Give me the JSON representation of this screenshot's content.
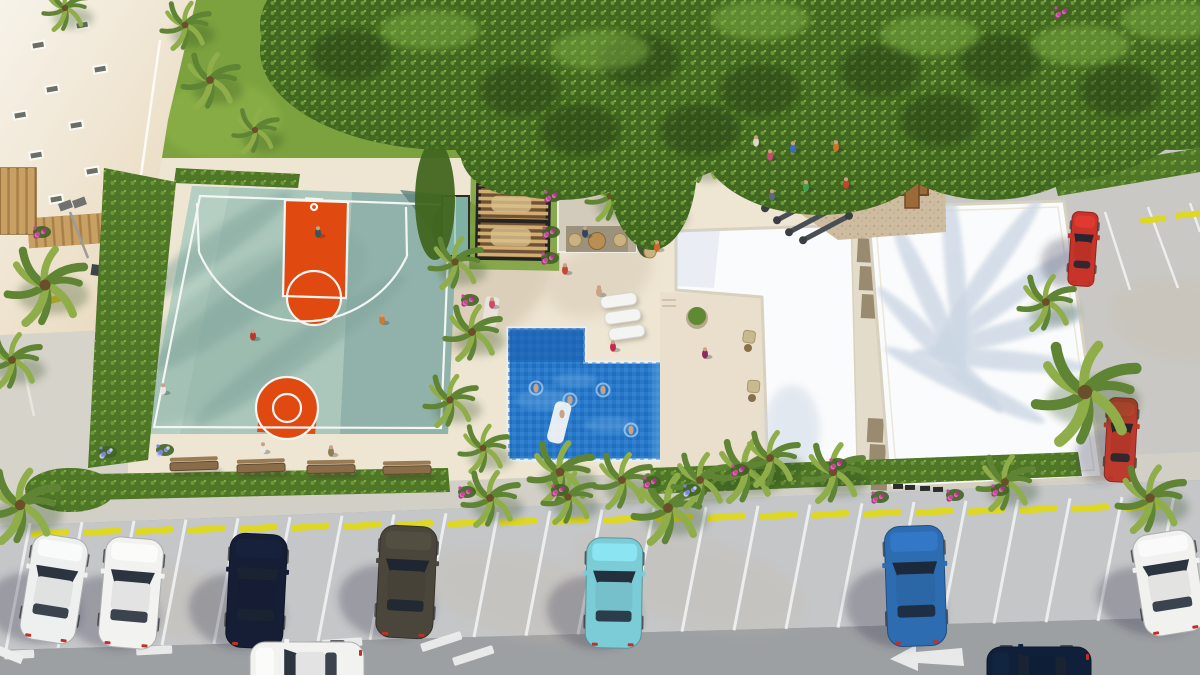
{
  "scene": {
    "name": "residential-amenity-aerial-render",
    "kind": "3d-architectural-rendering"
  },
  "palette": {
    "grass": "#7ca23f",
    "grassLight": "#93b74c",
    "canopyBG": "#31511a",
    "canopyBase": "#41661f",
    "canopyDark": "#283f12",
    "canopyLight": "#7fae44",
    "leafA": "#6d9c39",
    "leafB": "#507a27",
    "leafC": "#86b24a",
    "hedge": "#4f7527",
    "deck": "#eee5d3",
    "deckShadow": "#c9bba2",
    "pathGray": "#d6d3ca",
    "courtTeal": "#abc7bb",
    "courtShade": "#86aaa2",
    "courtDark": "#5d837b",
    "courtLight": "#bdd5c8",
    "courtOrange": "#e0490f",
    "lineWhite": "#f4f6f3",
    "poolBlue": "#2979cb",
    "poolDeep": "#1b5fae",
    "poolLight": "#6fb4e4",
    "poolEdge": "#e8f0f6",
    "poolTileA": "#3d8cd6",
    "poolTileB": "#1d62b2",
    "roofWhite": "#fafbfc",
    "roofShadow": "#ccd7e4",
    "parapet": "#d8d1c0",
    "walkway": "#e3dcca",
    "panelBrown": "#8d7c60",
    "kioskWall": "#d2cabb",
    "kioskShade": "#b5aa96",
    "kioskOpen": "#938871",
    "pergolaFrame": "#262420",
    "pergolaBase": "#6e5232",
    "pergolaSlat": "#d3ae74",
    "boothTeal": "#7fb0a4",
    "sand": "#cebca0",
    "sandDot": "#a98f6d",
    "woodPlay": "#9a6a39",
    "woodDark": "#6e4a26",
    "slideGreen": "#3fa43f",
    "slideYellow": "#ead32f",
    "pavement": "#c4c6c8",
    "pavement2": "#c9c8c4",
    "road": "#9da0a3",
    "sidewalk": "#d2cfc7",
    "stallLine": "#eceeee",
    "stopYellow": "#ded723",
    "benchWood": "#8a6c48",
    "benchBack": "#9a7c54",
    "buildingHi": "#f7f3ea",
    "buildingLo": "#e7d6b8",
    "plank": "#c9a063",
    "plankBase": "#a87f48",
    "palmA": "#8fae4a",
    "palmB": "#5f8433",
    "palmCore": "#6b4f2a",
    "skin": "#caa284",
    "glass": "#1b2431"
  },
  "canopy": {
    "blobs": [
      [
        450,
        50,
        190,
        100
      ],
      [
        370,
        25,
        110,
        70
      ],
      [
        620,
        75,
        170,
        115
      ],
      [
        560,
        115,
        115,
        85
      ],
      [
        760,
        38,
        130,
        85
      ],
      [
        700,
        90,
        70,
        70
      ],
      [
        900,
        60,
        190,
        105
      ],
      [
        820,
        140,
        120,
        75
      ],
      [
        990,
        120,
        120,
        80
      ],
      [
        1060,
        75,
        150,
        105
      ],
      [
        1175,
        45,
        130,
        105
      ],
      [
        652,
        165,
        45,
        85
      ],
      [
        515,
        150,
        55,
        45
      ]
    ],
    "dark": [
      [
        350,
        55
      ],
      [
        520,
        90
      ],
      [
        640,
        60
      ],
      [
        760,
        90
      ],
      [
        880,
        70
      ],
      [
        1000,
        60
      ],
      [
        1120,
        90
      ],
      [
        580,
        130
      ],
      [
        700,
        130
      ],
      [
        940,
        120
      ]
    ],
    "light": [
      [
        430,
        30
      ],
      [
        600,
        50
      ],
      [
        760,
        20
      ],
      [
        930,
        35
      ],
      [
        1080,
        45
      ],
      [
        1170,
        20
      ]
    ]
  },
  "palms": [
    [
      45,
      285,
      42
    ],
    [
      12,
      360,
      30
    ],
    [
      20,
      505,
      40
    ],
    [
      65,
      8,
      24
    ],
    [
      185,
      25,
      26
    ],
    [
      210,
      80,
      30
    ],
    [
      255,
      130,
      24
    ],
    [
      455,
      262,
      28
    ],
    [
      472,
      332,
      30
    ],
    [
      450,
      400,
      28
    ],
    [
      483,
      448,
      26
    ],
    [
      610,
      196,
      26
    ],
    [
      656,
      208,
      28
    ],
    [
      700,
      162,
      22
    ],
    [
      560,
      472,
      34
    ],
    [
      622,
      480,
      30
    ],
    [
      490,
      498,
      30
    ],
    [
      568,
      497,
      28
    ],
    [
      668,
      508,
      38
    ],
    [
      700,
      480,
      30
    ],
    [
      745,
      470,
      34
    ],
    [
      770,
      458,
      30
    ],
    [
      833,
      472,
      32
    ],
    [
      1005,
      482,
      30
    ],
    [
      1150,
      498,
      36
    ],
    [
      1085,
      392,
      55
    ],
    [
      1046,
      302,
      30
    ]
  ],
  "cars": [
    {
      "name": "white-hatchback-parked",
      "color": "#eef0ef",
      "x": 26,
      "y": 536,
      "w": 56,
      "h": 106,
      "rot": 9
    },
    {
      "name": "white-sedan-parked",
      "color": "#f2f2f1",
      "x": 102,
      "y": 538,
      "w": 58,
      "h": 110,
      "rot": 5
    },
    {
      "name": "navy-sedan-parked",
      "color": "#161e36",
      "x": 228,
      "y": 534,
      "w": 57,
      "h": 114,
      "rot": 3
    },
    {
      "name": "gray-suv-parked",
      "color": "#4a463b",
      "x": 378,
      "y": 526,
      "w": 57,
      "h": 112,
      "rot": 3
    },
    {
      "name": "cyan-sedan-parked",
      "color": "#7cccd8",
      "x": 586,
      "y": 538,
      "w": 56,
      "h": 110,
      "rot": 1
    },
    {
      "name": "blue-sedan-parked",
      "color": "#2e6cb2",
      "x": 886,
      "y": 526,
      "w": 59,
      "h": 120,
      "rot": -2
    },
    {
      "name": "white-coupe-parked",
      "color": "#f1f1f0",
      "x": 1138,
      "y": 532,
      "w": 62,
      "h": 102,
      "rot": -9
    },
    {
      "name": "white-car-driving",
      "color": "#f2f2f1",
      "x": 278,
      "y": 614,
      "w": 58,
      "h": 114,
      "rot": -90,
      "onroad": true
    },
    {
      "name": "navy-suv-driving",
      "color": "#10203a",
      "x": 1012,
      "y": 622,
      "w": 54,
      "h": 104,
      "rot": -90,
      "onroad": true
    },
    {
      "name": "red-car-upper-lot",
      "color": "#c8342a",
      "x": 1070,
      "y": 212,
      "w": 26,
      "h": 74,
      "rot": 4
    },
    {
      "name": "red-suv-upper-lot",
      "color": "#bd3b2c",
      "x": 1106,
      "y": 398,
      "w": 30,
      "h": 84,
      "rot": 3
    }
  ],
  "people": [
    [
      318,
      233,
      "#3a545e"
    ],
    [
      253,
      336,
      "#b5392a"
    ],
    [
      163,
      390,
      "#e9e7e2"
    ],
    [
      382,
      320,
      "#d07a2e"
    ],
    [
      772,
      196,
      "#5a6b7a"
    ],
    [
      263,
      449,
      "#ece8e0"
    ],
    [
      331,
      452,
      "#8a7f55"
    ],
    [
      565,
      270,
      "#c6453a"
    ],
    [
      599,
      292,
      "#caa284"
    ],
    [
      613,
      347,
      "#c22a50"
    ],
    [
      705,
      354,
      "#8a2a62"
    ],
    [
      585,
      233,
      "#35425e"
    ],
    [
      657,
      247,
      "#cc6a2a"
    ],
    [
      492,
      304,
      "#d24a6a"
    ],
    [
      770,
      156,
      "#cc4a6a"
    ],
    [
      793,
      148,
      "#3a6ac2"
    ],
    [
      836,
      147,
      "#d0722a"
    ],
    [
      806,
      187,
      "#42a048"
    ],
    [
      846,
      184,
      "#c2452e"
    ],
    [
      756,
      142,
      "#e2d8c8"
    ]
  ],
  "swimmers": [
    [
      536,
      388
    ],
    [
      570,
      400
    ],
    [
      603,
      390
    ],
    [
      631,
      430
    ],
    [
      562,
      414
    ]
  ],
  "flowers": [
    [
      553,
      196,
      "p"
    ],
    [
      551,
      232,
      "p"
    ],
    [
      550,
      258,
      "p"
    ],
    [
      470,
      300,
      "p"
    ],
    [
      467,
      492,
      "p"
    ],
    [
      560,
      490,
      "p"
    ],
    [
      652,
      482,
      "p"
    ],
    [
      692,
      490,
      "b"
    ],
    [
      740,
      470,
      "p"
    ],
    [
      838,
      464,
      "p"
    ],
    [
      880,
      497,
      "p"
    ],
    [
      955,
      495,
      "p"
    ],
    [
      1000,
      490,
      "p"
    ],
    [
      1063,
      12,
      "p"
    ],
    [
      165,
      450,
      "b"
    ],
    [
      108,
      452,
      "b"
    ],
    [
      42,
      232,
      "p"
    ]
  ],
  "benches": [
    [
      170,
      458,
      -2
    ],
    [
      237,
      460,
      -2
    ],
    [
      307,
      461,
      -1
    ],
    [
      383,
      462,
      -1
    ]
  ],
  "loungers": [
    [
      600,
      297
    ],
    [
      604,
      313
    ],
    [
      608,
      329
    ]
  ],
  "windows": [
    [
      74,
      22
    ],
    [
      30,
      42
    ],
    [
      92,
      66
    ],
    [
      44,
      86
    ],
    [
      12,
      112
    ],
    [
      68,
      122
    ],
    [
      28,
      152
    ],
    [
      84,
      168
    ],
    [
      48,
      196
    ],
    [
      8,
      214
    ]
  ],
  "stalls": {
    "first_x": 30,
    "spacing": 52,
    "count": 23,
    "tilt": -24
  },
  "roadMarkings": {
    "dashes": [
      [
        4,
        651,
        30,
        -3
      ],
      [
        136,
        647,
        36,
        -3
      ],
      [
        322,
        640,
        40,
        -4
      ],
      [
        420,
        644,
        42,
        -18
      ],
      [
        452,
        658,
        42,
        -18
      ]
    ],
    "arrow": "890,659 916,645 916,652 962,648 964,666 918,663 918,671",
    "curb": [
      0,
      646,
      26,
      22
    ]
  },
  "upperLot": {
    "yellowDashes": [
      [
        1140,
        218
      ],
      [
        1175,
        213
      ]
    ],
    "whiteLines": [
      [
        1105,
        212,
        1130,
        290
      ],
      [
        1148,
        207,
        1178,
        288
      ],
      [
        1190,
        203,
        1200,
        232
      ]
    ]
  },
  "walkwayPanels": [
    [
      858,
      238
    ],
    [
      860,
      266
    ],
    [
      862,
      294
    ],
    [
      868,
      418
    ],
    [
      870,
      444
    ],
    [
      872,
      466
    ]
  ],
  "roofVents": [
    [
      893,
      484
    ],
    [
      905,
      485
    ],
    [
      920,
      486
    ],
    [
      933,
      487
    ]
  ],
  "gym": [
    [
      446,
      210,
      -20
    ],
    [
      458,
      227,
      -15
    ],
    [
      443,
      243,
      -25
    ]
  ]
}
